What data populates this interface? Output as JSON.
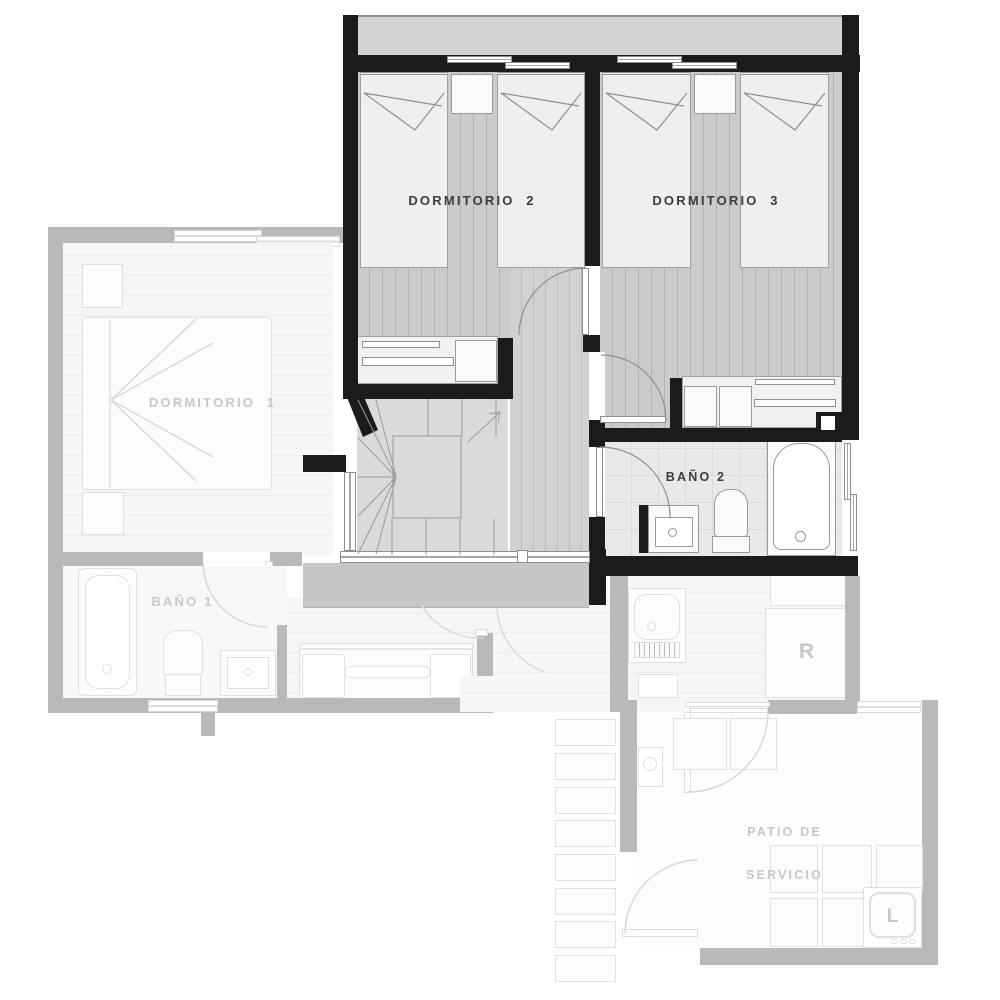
{
  "labels": {
    "dormitorio_2": "DORMITORIO  2",
    "dormitorio_3": "DORMITORIO  3",
    "dormitorio_1": "DORMITORIO  1",
    "bano_2": "BAÑO 2",
    "bano_1": "BAÑO 1",
    "patio_line_1": "PATIO DE",
    "patio_line_2": "SERVICIO",
    "refrigerator": "R",
    "washer": "L"
  },
  "colors": {
    "wall_active": "#1b1b1b",
    "wall_ghost": "#b9b9b9",
    "band": "#c7c7c7",
    "terrace": "#d2d2d2",
    "floor_planks": "#cbcbcb",
    "plank_line": "#b3b3b3",
    "floor_hall": "#d1d1d1",
    "hall_line": "#bcbcbc",
    "floor_stairs": "#dadada",
    "floor_ghost": "#f6f6f6",
    "ghost_line": "#ececec",
    "bath_floor": "#e9e9e9",
    "bath_grid": "#dadada",
    "fixture_active_border": "#9a9a9a",
    "fixture_ghost_border": "#e0e0e0",
    "label_active": "#3c3c3c",
    "label_ghost": "#c8c8c8",
    "stroke_active": "#8f8f8f",
    "stroke_ghost": "#d9d9d9"
  }
}
